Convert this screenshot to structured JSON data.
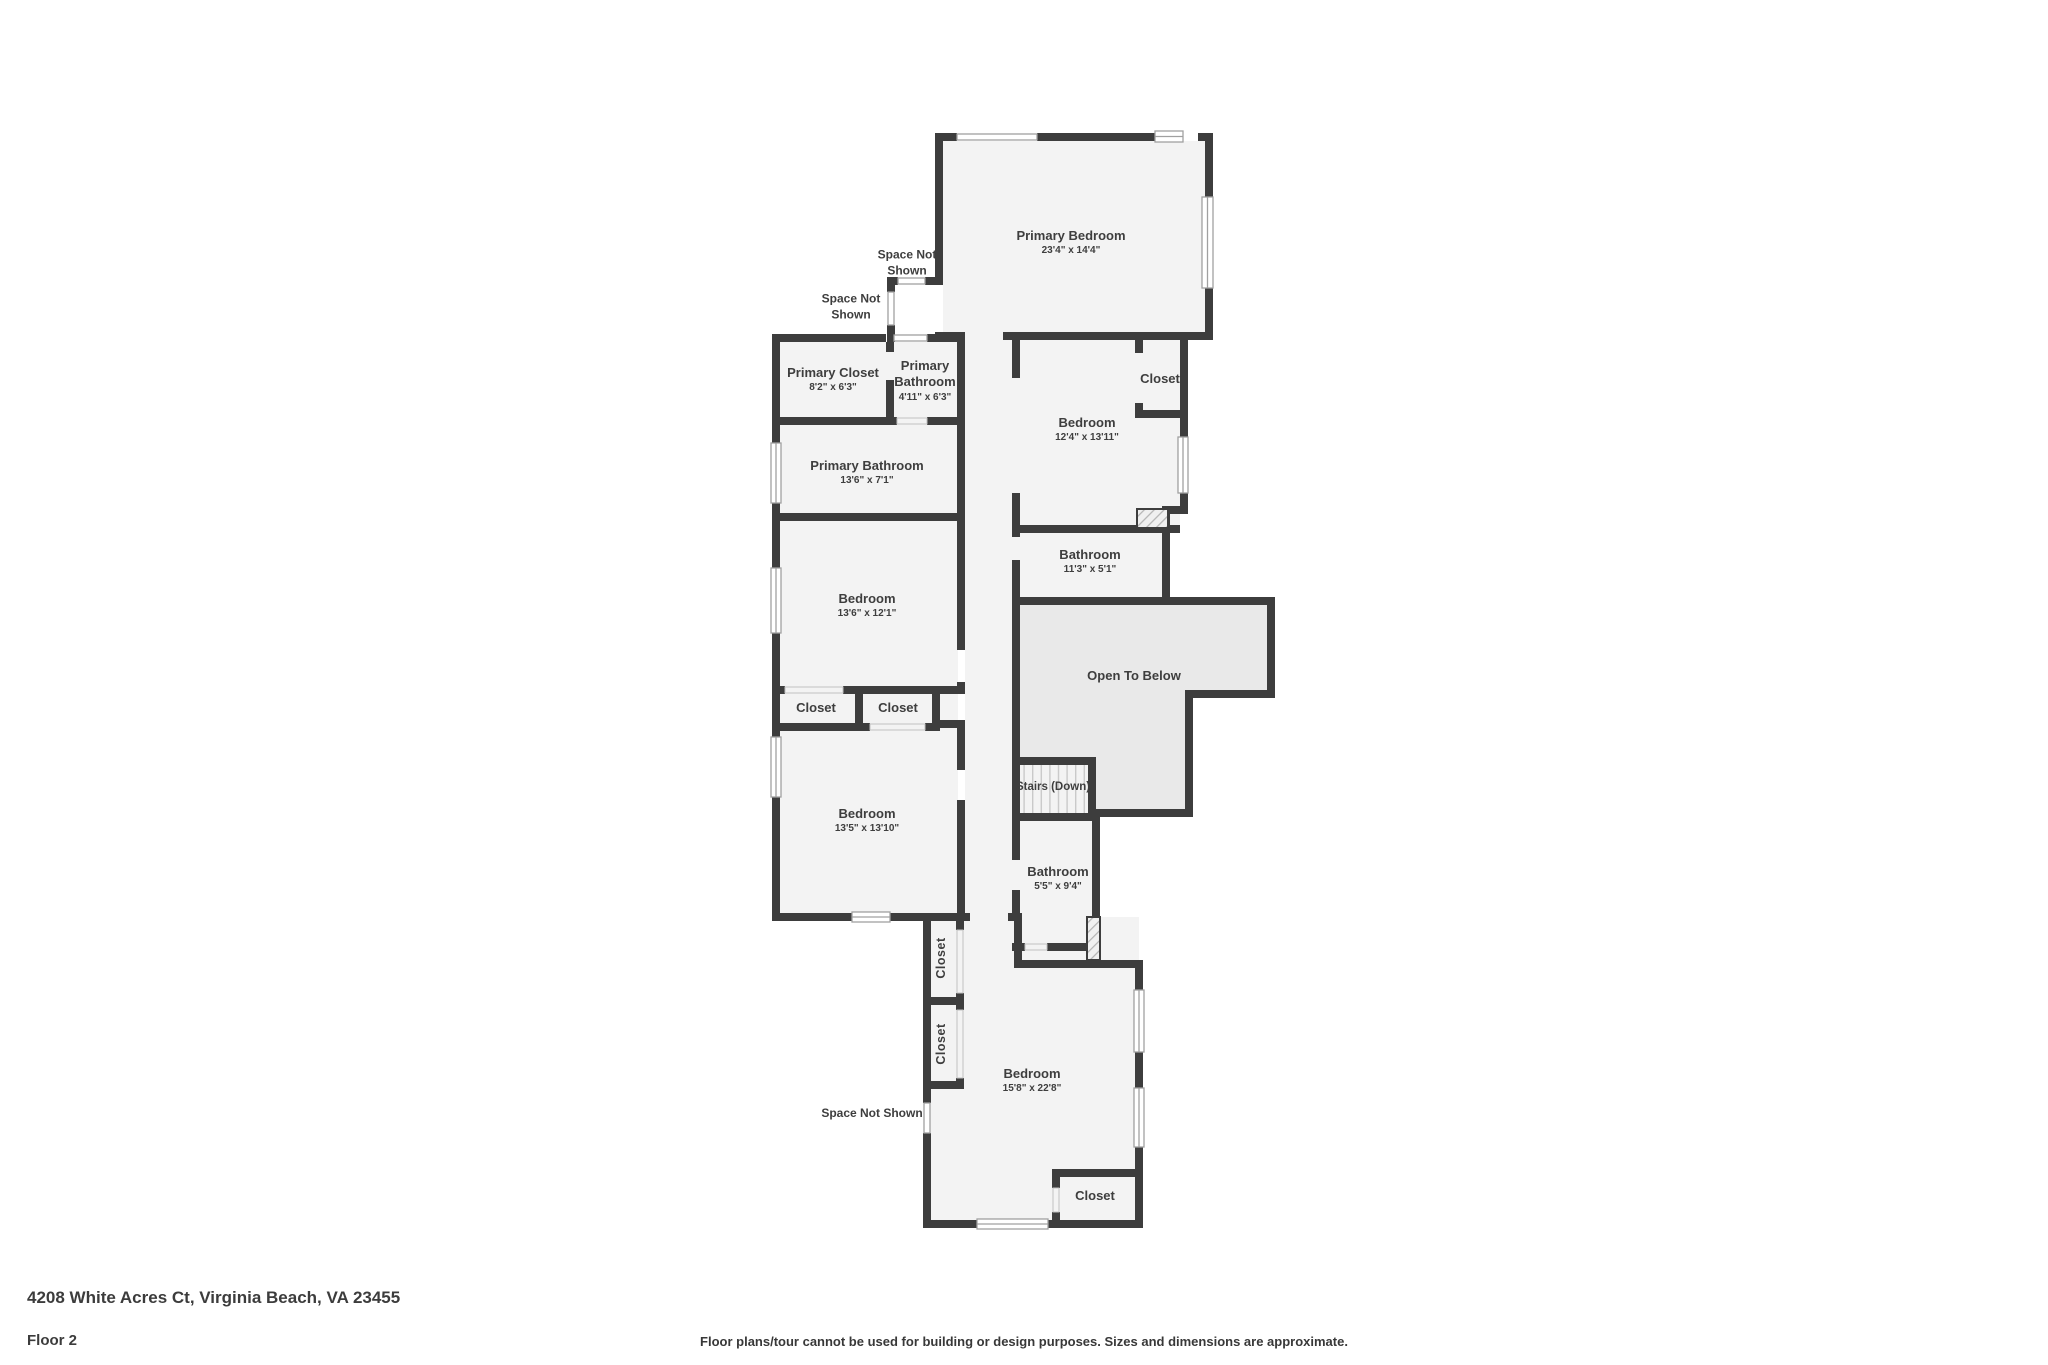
{
  "colors": {
    "wall": "#3d3d3d",
    "room_fill": "#f3f3f3",
    "open_below_fill": "#e9e9e9",
    "window_stroke": "#a0a0a0",
    "label_text": "#3e3e3e"
  },
  "plan": {
    "rooms": [
      {
        "id": "primary-bedroom",
        "name": "Primary Bedroom",
        "dims": "23'4\" x 14'4\"",
        "x": 1071,
        "y": 243
      },
      {
        "id": "primary-closet",
        "name": "Primary Closet",
        "dims": "8'2\" x 6'3\"",
        "x": 833,
        "y": 380
      },
      {
        "id": "primary-bathroom-small",
        "name": "Primary Bathroom",
        "dims": "4'11\" x 6'3\"",
        "x": 925,
        "y": 381,
        "w": 78
      },
      {
        "id": "primary-bathroom",
        "name": "Primary Bathroom",
        "dims": "13'6\" x 7'1\"",
        "x": 867,
        "y": 473
      },
      {
        "id": "bedroom-2",
        "name": "Bedroom",
        "dims": "13'6\" x 12'1\"",
        "x": 867,
        "y": 606
      },
      {
        "id": "closet-a",
        "name": "Closet",
        "x": 816,
        "y": 708
      },
      {
        "id": "closet-b",
        "name": "Closet",
        "x": 898,
        "y": 708
      },
      {
        "id": "bedroom-3",
        "name": "Bedroom",
        "dims": "13'5\" x 13'10\"",
        "x": 867,
        "y": 821
      },
      {
        "id": "bedroom-4",
        "name": "Bedroom",
        "dims": "12'4\" x 13'11\"",
        "x": 1087,
        "y": 430
      },
      {
        "id": "closet-c",
        "name": "Closet",
        "x": 1160,
        "y": 379
      },
      {
        "id": "bathroom-2",
        "name": "Bathroom",
        "dims": "11'3\" x 5'1\"",
        "x": 1090,
        "y": 562
      },
      {
        "id": "open-to-below",
        "name": "Open To Below",
        "x": 1134,
        "y": 676
      },
      {
        "id": "stairs-down",
        "name": "Stairs (Down)",
        "x": 1053,
        "y": 787,
        "size": "xs"
      },
      {
        "id": "bathroom-3",
        "name": "Bathroom",
        "dims": "5'5\" x 9'4\"",
        "x": 1058,
        "y": 879
      },
      {
        "id": "closet-d",
        "name": "Closet",
        "x": 942,
        "y": 958,
        "rotate": true
      },
      {
        "id": "closet-e",
        "name": "Closet",
        "x": 942,
        "y": 1044,
        "rotate": true
      },
      {
        "id": "bedroom-5",
        "name": "Bedroom",
        "dims": "15'8\" x 22'8\"",
        "x": 1032,
        "y": 1081
      },
      {
        "id": "closet-f",
        "name": "Closet",
        "x": 1095,
        "y": 1196
      }
    ],
    "annotations": [
      {
        "id": "space-not-shown-1",
        "text": "Space Not Shown",
        "x": 907,
        "y": 263,
        "w": 80
      },
      {
        "id": "space-not-shown-2",
        "text": "Space Not Shown",
        "x": 851,
        "y": 307,
        "w": 80
      },
      {
        "id": "space-not-shown-3",
        "text": "Space Not Shown",
        "x": 872,
        "y": 1114,
        "w": 180
      }
    ]
  },
  "footer": {
    "address": "4208 White Acres Ct, Virginia Beach, VA 23455",
    "floor": "Floor 2",
    "disclaimer": "Floor plans/tour cannot be used for building or design purposes. Sizes and dimensions are approximate."
  }
}
